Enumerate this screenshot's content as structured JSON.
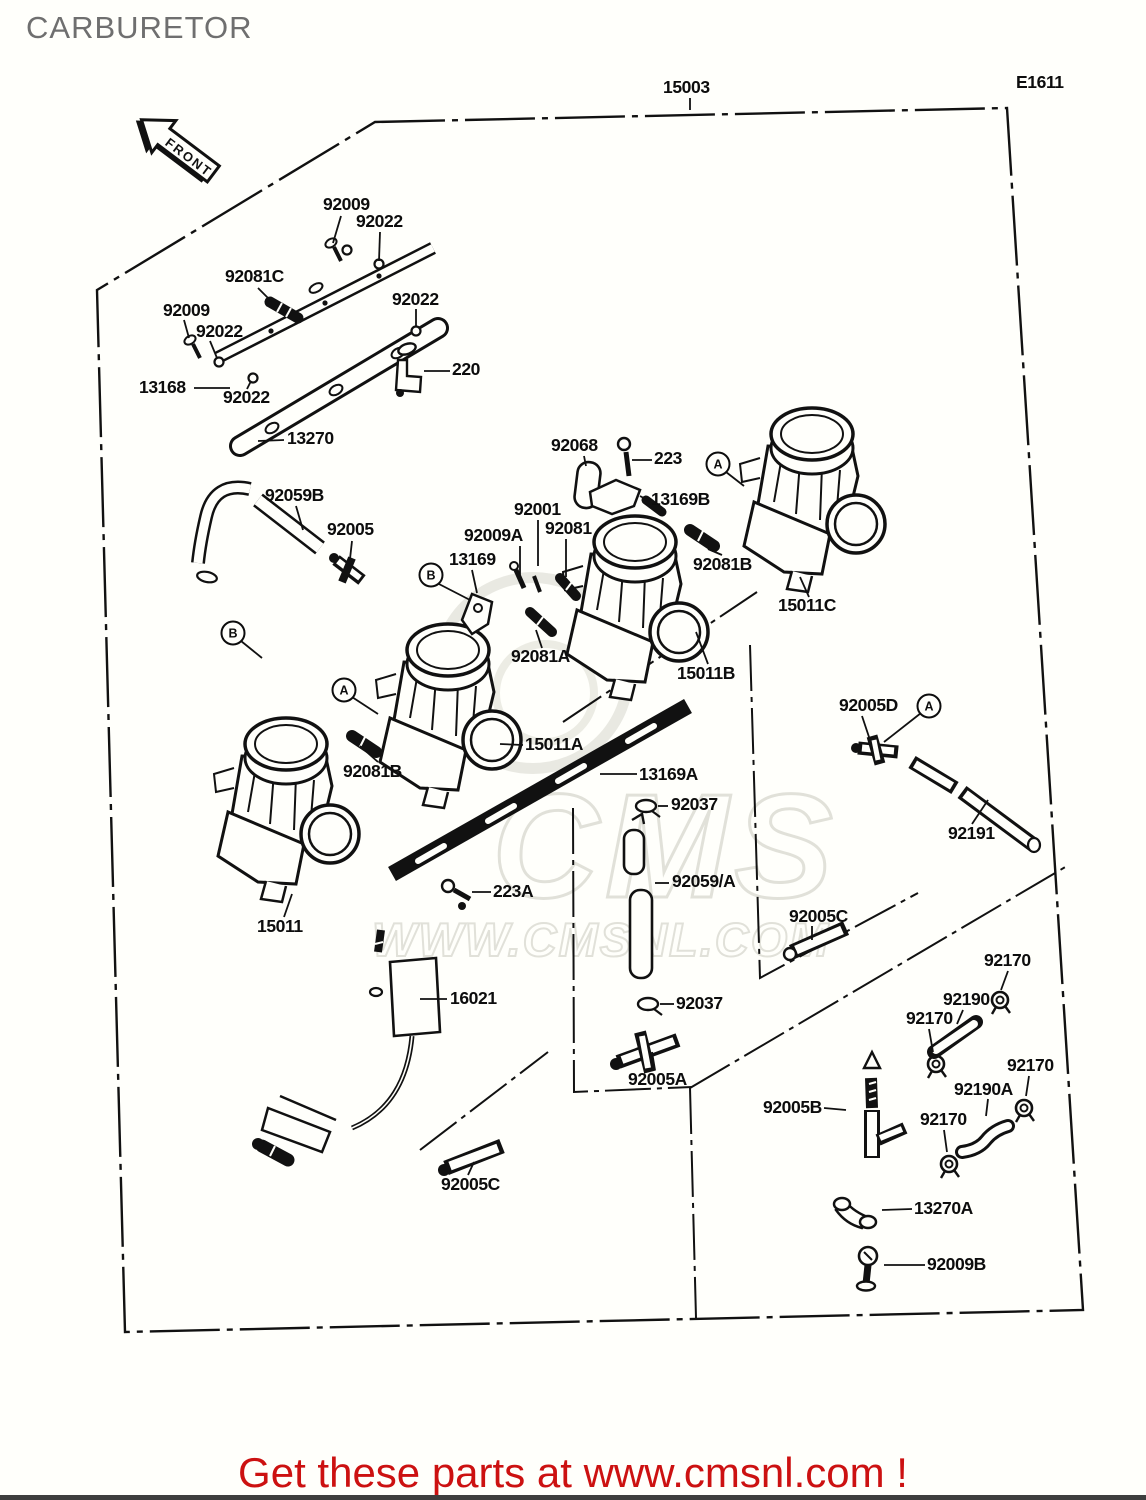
{
  "page": {
    "title_header": "CARBURETOR",
    "assembly_number": "15003",
    "diagram_code": "E1611",
    "front_label": "FRONT",
    "footer_text": "Get these parts at www.cmsnl.com !",
    "watermark_line1": "CMS",
    "watermark_line2": "WWW.CMSNL.COM",
    "colors": {
      "footer_red": "#cc1111",
      "title_gray": "#6f6f6f",
      "line_black": "#0d0d0d",
      "background": "#fffffb",
      "watermark_gray": "#dcdcd4"
    }
  },
  "labels": [
    {
      "text": "15003",
      "x": 663,
      "y": 79,
      "name": "assembly-number"
    },
    {
      "text": "E1611",
      "x": 1016,
      "y": 74,
      "name": "diagram-code"
    },
    {
      "text": "92009",
      "x": 323,
      "y": 196
    },
    {
      "text": "92022",
      "x": 356,
      "y": 213
    },
    {
      "text": "92081C",
      "x": 225,
      "y": 268
    },
    {
      "text": "92022",
      "x": 392,
      "y": 291
    },
    {
      "text": "92009",
      "x": 163,
      "y": 302
    },
    {
      "text": "92022",
      "x": 196,
      "y": 323
    },
    {
      "text": "13168",
      "x": 139,
      "y": 379
    },
    {
      "text": "92022",
      "x": 223,
      "y": 389
    },
    {
      "text": "220",
      "x": 452,
      "y": 361
    },
    {
      "text": "13270",
      "x": 287,
      "y": 430
    },
    {
      "text": "92059B",
      "x": 265,
      "y": 487
    },
    {
      "text": "92005",
      "x": 327,
      "y": 521
    },
    {
      "text": "92068",
      "x": 551,
      "y": 437
    },
    {
      "text": "223",
      "x": 654,
      "y": 450
    },
    {
      "text": "13169B",
      "x": 651,
      "y": 491
    },
    {
      "text": "92001",
      "x": 514,
      "y": 501
    },
    {
      "text": "92009A",
      "x": 464,
      "y": 527
    },
    {
      "text": "92081",
      "x": 545,
      "y": 520
    },
    {
      "text": "13169",
      "x": 449,
      "y": 551
    },
    {
      "text": "92081A",
      "x": 511,
      "y": 648
    },
    {
      "text": "92081B",
      "x": 693,
      "y": 556
    },
    {
      "text": "15011C",
      "x": 778,
      "y": 597
    },
    {
      "text": "15011B",
      "x": 677,
      "y": 665
    },
    {
      "text": "15011A",
      "x": 525,
      "y": 736
    },
    {
      "text": "92081B",
      "x": 343,
      "y": 763
    },
    {
      "text": "13169A",
      "x": 639,
      "y": 766
    },
    {
      "text": "92037",
      "x": 671,
      "y": 796
    },
    {
      "text": "92059/A",
      "x": 672,
      "y": 873
    },
    {
      "text": "92005D",
      "x": 839,
      "y": 697
    },
    {
      "text": "92191",
      "x": 948,
      "y": 825
    },
    {
      "text": "92005C",
      "x": 789,
      "y": 908
    },
    {
      "text": "223A",
      "x": 493,
      "y": 883
    },
    {
      "text": "15011",
      "x": 257,
      "y": 918
    },
    {
      "text": "16021",
      "x": 450,
      "y": 990
    },
    {
      "text": "92037",
      "x": 676,
      "y": 995
    },
    {
      "text": "92005A",
      "x": 628,
      "y": 1071
    },
    {
      "text": "92005C",
      "x": 441,
      "y": 1176
    },
    {
      "text": "92005B",
      "x": 763,
      "y": 1099
    },
    {
      "text": "92170",
      "x": 984,
      "y": 952
    },
    {
      "text": "92190",
      "x": 943,
      "y": 991
    },
    {
      "text": "92170",
      "x": 906,
      "y": 1010
    },
    {
      "text": "92170",
      "x": 1007,
      "y": 1057
    },
    {
      "text": "92190A",
      "x": 954,
      "y": 1081
    },
    {
      "text": "92170",
      "x": 920,
      "y": 1111
    },
    {
      "text": "13270A",
      "x": 914,
      "y": 1200
    },
    {
      "text": "92009B",
      "x": 927,
      "y": 1256
    }
  ],
  "callouts": [
    {
      "letter": "A",
      "x": 718,
      "y": 464
    },
    {
      "letter": "B",
      "x": 431,
      "y": 575
    },
    {
      "letter": "A",
      "x": 344,
      "y": 690
    },
    {
      "letter": "B",
      "x": 233,
      "y": 633
    },
    {
      "letter": "A",
      "x": 929,
      "y": 706
    }
  ]
}
